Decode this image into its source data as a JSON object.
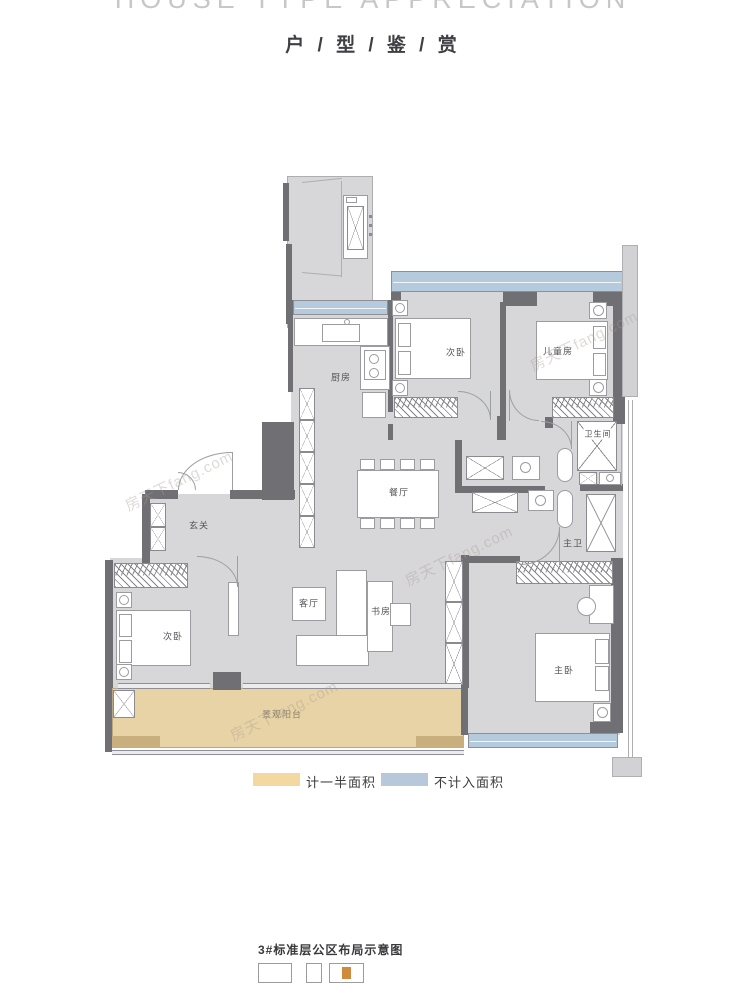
{
  "header": {
    "title_en": "HOUSE TYPE APPRECIATION",
    "title_cn": "户 / 型 / 鉴 / 赏"
  },
  "floorplan": {
    "rooms": {
      "kitchen": "厨房",
      "bedroom_top": "次卧",
      "kids_room": "儿童房",
      "bathroom": "卫生间",
      "dining": "餐厅",
      "foyer": "玄关",
      "bedroom_left": "次卧",
      "living": "客厅",
      "study": "书房",
      "master_bath": "主卫",
      "master_bedroom": "主卧",
      "balcony": "景观阳台"
    },
    "colors": {
      "wall": "#6f6f74",
      "floor": "#d7d7d9",
      "half_area": "#f3d9a1",
      "excluded_area": "#b7c8db",
      "balcony_fill": "#e7d3a6"
    },
    "watermark": "房天下fang.com"
  },
  "legend": {
    "items": [
      {
        "label": "计一半面积",
        "color": "#f3d9a1"
      },
      {
        "label": "不计入面积",
        "color": "#b7c8db"
      }
    ]
  },
  "footer": {
    "caption": "3#标准层公区布局示意图"
  }
}
